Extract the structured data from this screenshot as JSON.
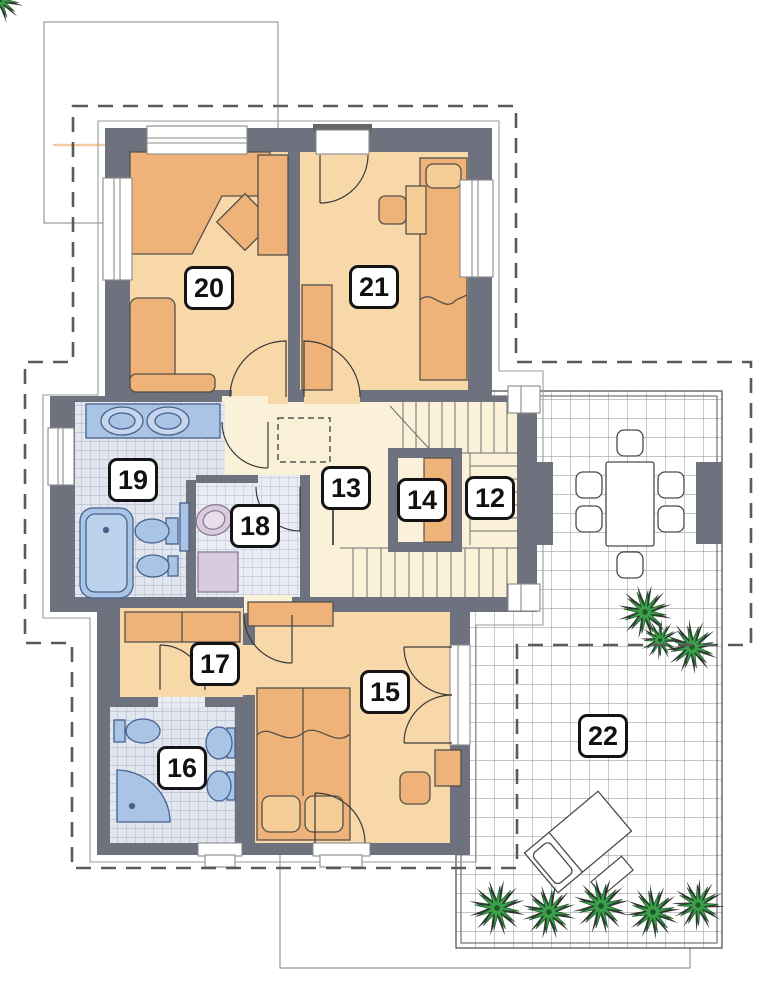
{
  "document": {
    "type": "architectural-floor-plan",
    "floor": "upper-storey"
  },
  "rooms": [
    {
      "number": "20"
    },
    {
      "number": "21"
    },
    {
      "number": "19"
    },
    {
      "number": "18"
    },
    {
      "number": "13"
    },
    {
      "number": "14"
    },
    {
      "number": "12"
    },
    {
      "number": "17"
    },
    {
      "number": "16"
    },
    {
      "number": "15"
    },
    {
      "number": "22"
    }
  ],
  "colors": {
    "wall": "#6d727e",
    "room_floor": "#f8d8a8",
    "hall_floor": "#fbf1d9",
    "furniture": "#efb279",
    "bath_fixture": "#a9c4e4",
    "laundry_fixture": "#d9cadd",
    "plant_green": "#3da04b",
    "terrace_grid": "#8b8b8b",
    "roof_outline_dash": "#5a5a5a"
  }
}
